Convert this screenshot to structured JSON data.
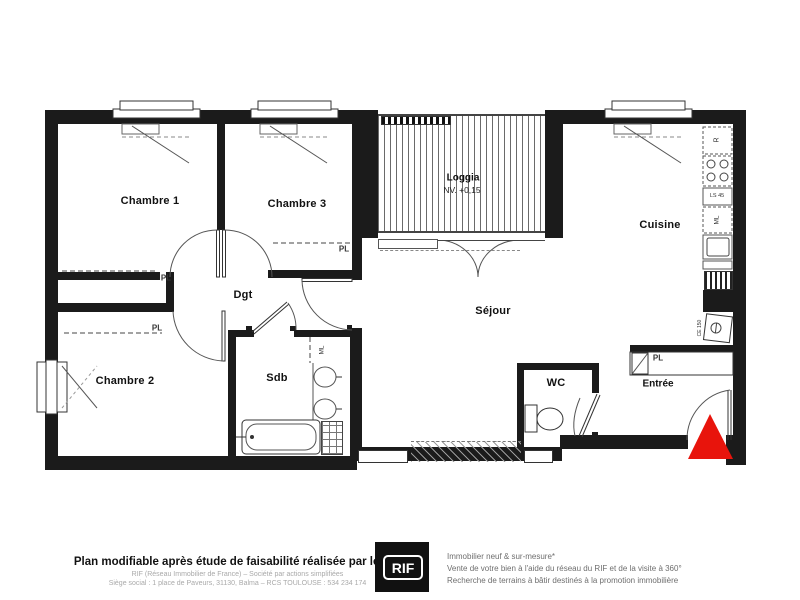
{
  "plan": {
    "rooms": {
      "chambre1": "Chambre 1",
      "chambre3": "Chambre 3",
      "chambre2": "Chambre 2",
      "dgt": "Dgt",
      "sdb": "Sdb",
      "sejour": "Séjour",
      "cuisine": "Cuisine",
      "wc": "WC",
      "entree": "Entrée",
      "loggia": "Loggia",
      "loggia_level": "NV. +0,15"
    },
    "labels": {
      "closet": "PL"
    },
    "kitchen": {
      "fridge": "R",
      "dishwasher": "LS 45",
      "washer": "ML"
    },
    "bath": {
      "washer": "ML"
    },
    "entry": {
      "water_heater": "CE 150"
    },
    "colors": {
      "wall": "#1b1b1b",
      "entrance_marker": "#e8140c"
    }
  },
  "footer": {
    "title": "Plan modifiable après étude de faisabilité réalisée par le RIF",
    "company_line1": "RIF (Réseau Immobilier de France) – Société par actions simplifiées",
    "company_line2": "Siège social : 1 place de Paveurs, 31130, Balma – RCS TOULOUSE : 534 234 174",
    "logo": "RIF",
    "tagline1": "Immobilier neuf & sur-mesure*",
    "tagline2": "Vente de votre bien à l'aide du réseau du RIF et de la visite à 360°",
    "tagline3": "Recherche de terrains à bâtir destinés à la promotion immobilière"
  }
}
